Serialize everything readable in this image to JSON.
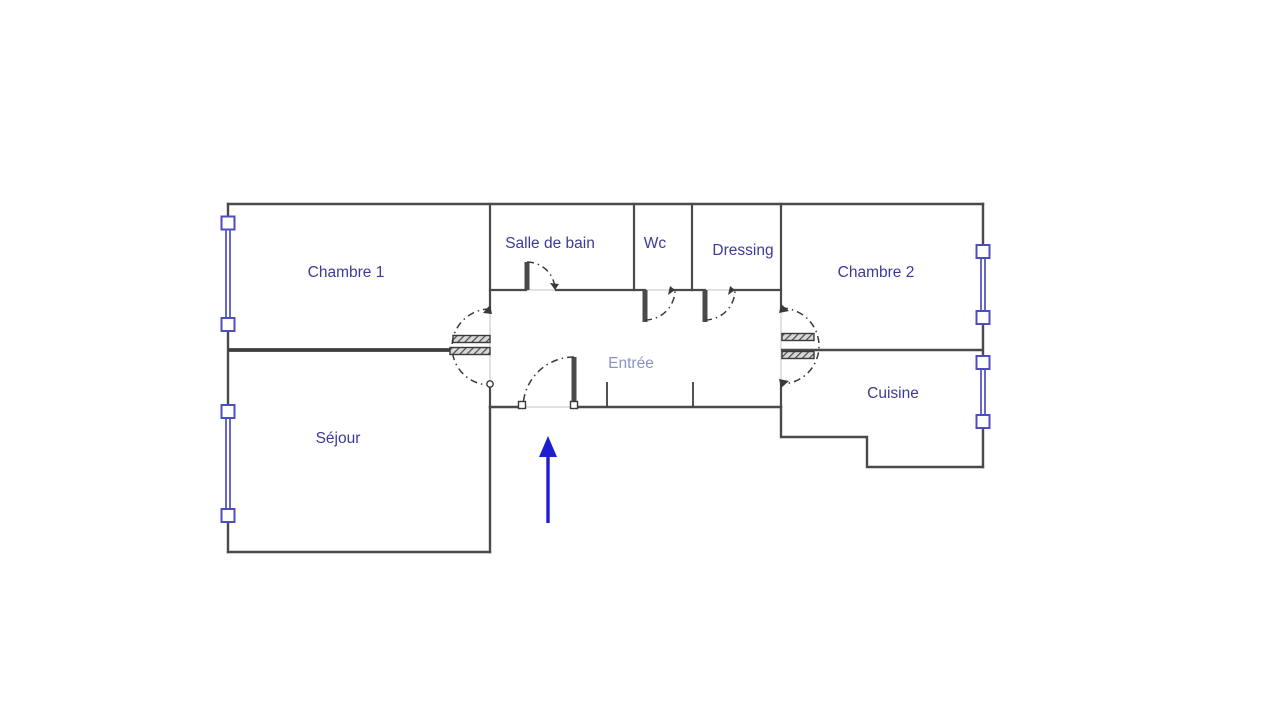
{
  "plan": {
    "type": "apartment-floor-plan",
    "rooms": [
      {
        "name": "chambre-1",
        "label": "Chambre 1"
      },
      {
        "name": "sejour",
        "label": "Séjour"
      },
      {
        "name": "salle-de-bain",
        "label": "Salle de bain"
      },
      {
        "name": "wc",
        "label": "Wc"
      },
      {
        "name": "dressing",
        "label": "Dressing"
      },
      {
        "name": "entree",
        "label": "Entrée"
      },
      {
        "name": "chambre-2",
        "label": "Chambre 2"
      },
      {
        "name": "cuisine",
        "label": "Cuisine"
      }
    ],
    "entrance_marker": {
      "icon": "up-arrow",
      "meaning": "main entrance direction"
    },
    "colors": {
      "background": "#ffffff",
      "wall": "#4a4a4a",
      "window": "#4d4dc2",
      "label": "#3b3b97",
      "entree_label": "#8a92c9",
      "arrow": "#1e1ecf"
    }
  }
}
